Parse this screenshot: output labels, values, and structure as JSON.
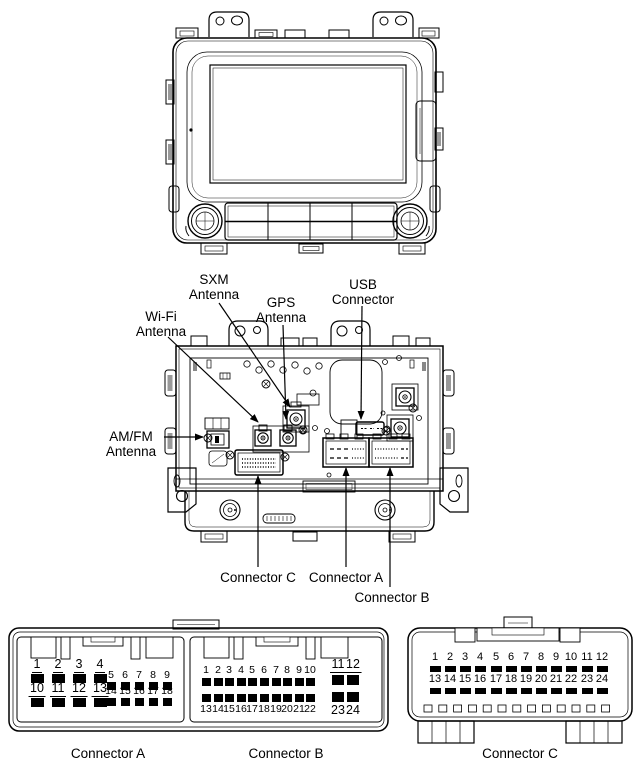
{
  "figure_title": "Head unit front and rear view with connector pinouts",
  "colors": {
    "line": "#000000",
    "background": "#ffffff"
  },
  "callouts": {
    "sxm_antenna": {
      "line1": "SXM",
      "line2": "Antenna"
    },
    "gps_antenna": {
      "line1": "GPS",
      "line2": "Antenna"
    },
    "usb_connector": {
      "line1": "USB",
      "line2": "Connector"
    },
    "wifi_antenna": {
      "line1": "Wi-Fi",
      "line2": "Antenna"
    },
    "amfm_antenna": {
      "line1": "AM/FM",
      "line2": "Antenna"
    },
    "connector_c": "Connector C",
    "connector_a": "Connector A",
    "connector_b": "Connector B"
  },
  "pinouts": {
    "connector_a": {
      "label": "Connector A",
      "large_top": [
        1,
        2,
        3,
        4
      ],
      "small_top": [
        5,
        6,
        7,
        8,
        9
      ],
      "large_bottom": [
        10,
        11,
        12,
        13
      ],
      "small_bottom": [
        14,
        15,
        16,
        17,
        18
      ]
    },
    "connector_b": {
      "label": "Connector B",
      "small_top": [
        1,
        2,
        3,
        4,
        5,
        6,
        7,
        8,
        9,
        10
      ],
      "large_top": [
        11,
        12
      ],
      "small_bottom": [
        13,
        14,
        15,
        16,
        17,
        18,
        19,
        20,
        21,
        22
      ],
      "large_bottom": [
        23,
        24
      ]
    },
    "connector_c": {
      "label": "Connector C",
      "top": [
        1,
        2,
        3,
        4,
        5,
        6,
        7,
        8,
        9,
        10,
        11,
        12
      ],
      "bottom": [
        13,
        14,
        15,
        16,
        17,
        18,
        19,
        20,
        21,
        22,
        23,
        24
      ]
    }
  }
}
